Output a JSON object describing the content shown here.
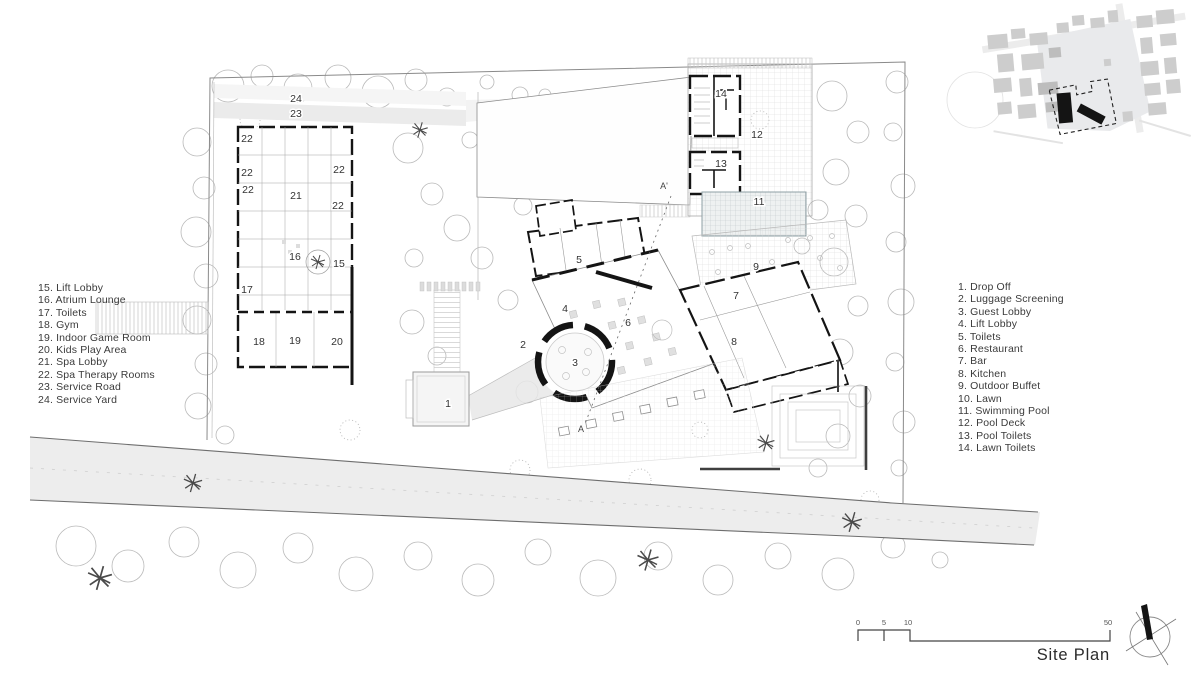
{
  "title": "Site Plan",
  "legend_left": {
    "items": [
      "15. Lift Lobby",
      "16. Atrium Lounge",
      "17. Toilets",
      "18. Gym",
      "19. Indoor Game Room",
      "20. Kids Play Area",
      "21. Spa Lobby",
      "22. Spa Therapy Rooms",
      "23. Service Road",
      "24. Service Yard"
    ]
  },
  "legend_right": {
    "items": [
      "1. Drop Off",
      "2. Luggage Screening",
      "3. Guest Lobby",
      "4. Lift Lobby",
      "5. Toilets",
      "6. Restaurant",
      "7. Bar",
      "8. Kitchen",
      "9. Outdoor Buffet",
      "10. Lawn",
      "11. Swimming Pool",
      "12. Pool Deck",
      "13. Pool Toilets",
      "14. Lawn Toilets"
    ]
  },
  "plan_labels": [
    {
      "n": "1",
      "x": 448,
      "y": 403
    },
    {
      "n": "2",
      "x": 523,
      "y": 344
    },
    {
      "n": "3",
      "x": 575,
      "y": 362
    },
    {
      "n": "4",
      "x": 565,
      "y": 308
    },
    {
      "n": "5",
      "x": 579,
      "y": 259
    },
    {
      "n": "6",
      "x": 628,
      "y": 322
    },
    {
      "n": "7",
      "x": 736,
      "y": 295
    },
    {
      "n": "8",
      "x": 734,
      "y": 341
    },
    {
      "n": "9",
      "x": 756,
      "y": 266
    },
    {
      "n": "11",
      "x": 759,
      "y": 201
    },
    {
      "n": "12",
      "x": 757,
      "y": 134
    },
    {
      "n": "13",
      "x": 721,
      "y": 163
    },
    {
      "n": "14",
      "x": 721,
      "y": 93
    },
    {
      "n": "15",
      "x": 339,
      "y": 263
    },
    {
      "n": "16",
      "x": 295,
      "y": 256
    },
    {
      "n": "17",
      "x": 247,
      "y": 289
    },
    {
      "n": "18",
      "x": 259,
      "y": 341
    },
    {
      "n": "19",
      "x": 295,
      "y": 340
    },
    {
      "n": "20",
      "x": 337,
      "y": 341
    },
    {
      "n": "21",
      "x": 296,
      "y": 195
    },
    {
      "n": "22",
      "x": 247,
      "y": 138
    },
    {
      "n": "22",
      "x": 247,
      "y": 172
    },
    {
      "n": "22",
      "x": 248,
      "y": 189
    },
    {
      "n": "22",
      "x": 339,
      "y": 169
    },
    {
      "n": "22",
      "x": 338,
      "y": 205
    },
    {
      "n": "23",
      "x": 296,
      "y": 113
    },
    {
      "n": "24",
      "x": 296,
      "y": 98
    }
  ],
  "section_markers": {
    "top": "A'",
    "bottom": "A"
  },
  "scale_bar": {
    "ticks": [
      "0",
      "5",
      "10",
      "50"
    ]
  },
  "colors": {
    "ink": "#2b2b2b",
    "wall": "#141414",
    "road_fill": "#ededed",
    "tree_stroke": "#b5b5b5",
    "inset_block": "#cdcdcd",
    "inset_site": "#141414",
    "inset_parcel": "#e9eaec"
  }
}
